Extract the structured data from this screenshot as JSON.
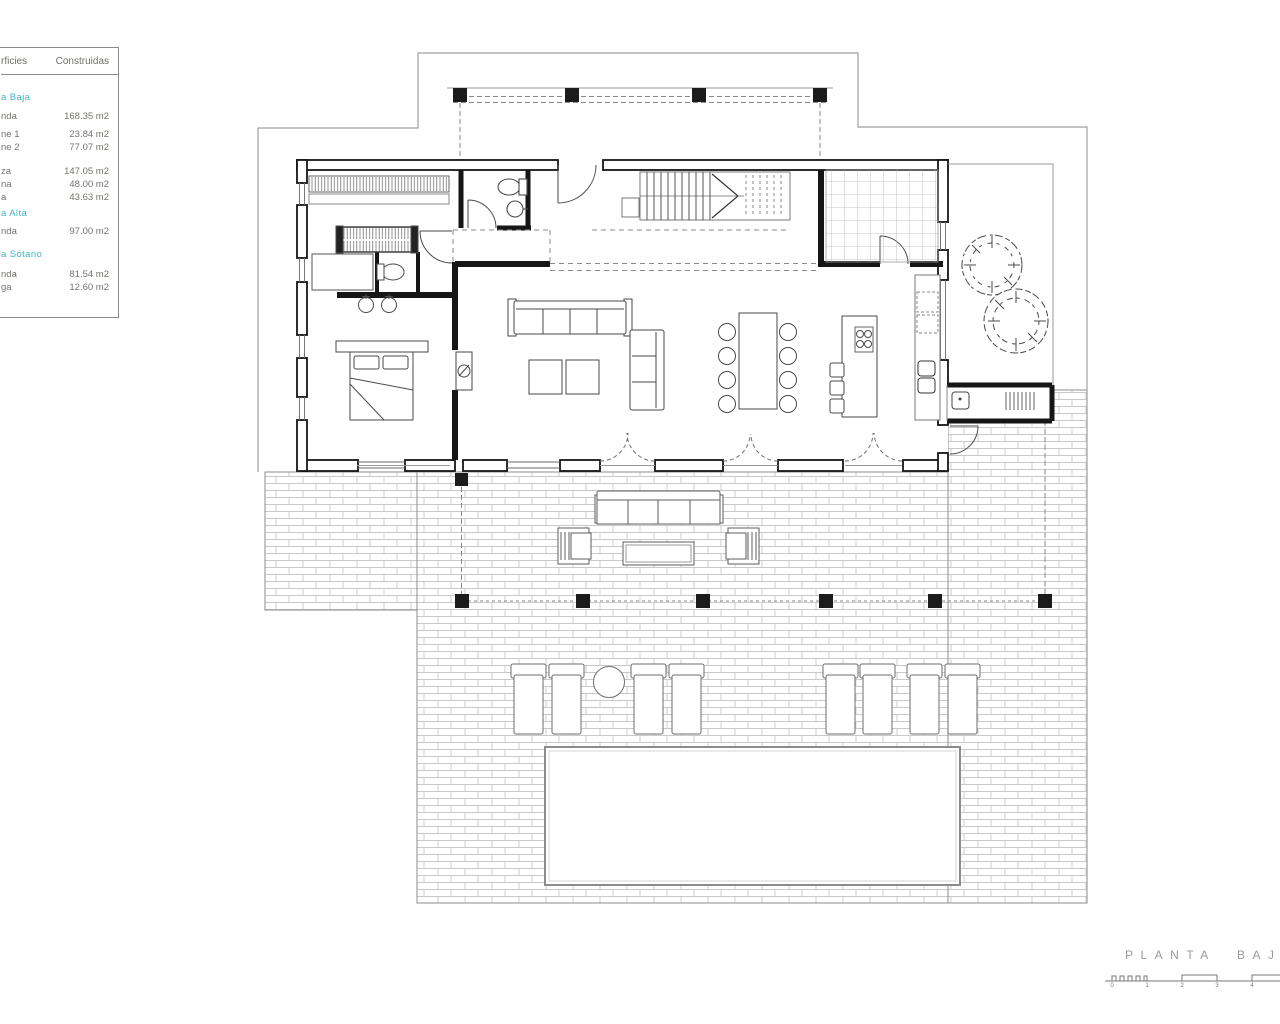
{
  "surface_table": {
    "header": {
      "col_label": "rficies",
      "col_value": "Construidas"
    },
    "sections": [
      {
        "heading": "a Baja",
        "rows": [
          {
            "label": "nda",
            "value": "168.35 m2"
          },
          {
            "label": "ne 1",
            "value": "23.84 m2"
          },
          {
            "label": "ne 2",
            "value": "77.07 m2"
          }
        ]
      },
      {
        "heading": "",
        "rows": [
          {
            "label": "za",
            "value": "147.05 m2"
          },
          {
            "label": "na",
            "value": "48.00 m2"
          },
          {
            "label": "a",
            "value": "43.63 m2"
          }
        ]
      },
      {
        "heading": "a Alta",
        "rows": [
          {
            "label": "nda",
            "value": "97.00 m2"
          }
        ]
      },
      {
        "heading": "a Sótano",
        "rows": [
          {
            "label": "nda",
            "value": "81.54 m2"
          },
          {
            "label": "ga",
            "value": "12.60 m2"
          }
        ]
      }
    ]
  },
  "plan_title": {
    "text": "PLANTA BAJ"
  },
  "scale_bar": {
    "labels": [
      "0",
      "1",
      "2",
      "3",
      "4"
    ]
  },
  "colors": {
    "accent_teal": "#3fb4c4",
    "text_gray": "#73736d",
    "wall_dark": "#161616",
    "line_gray": "#9a9a9a",
    "tile_gray": "#c6c6c6"
  }
}
